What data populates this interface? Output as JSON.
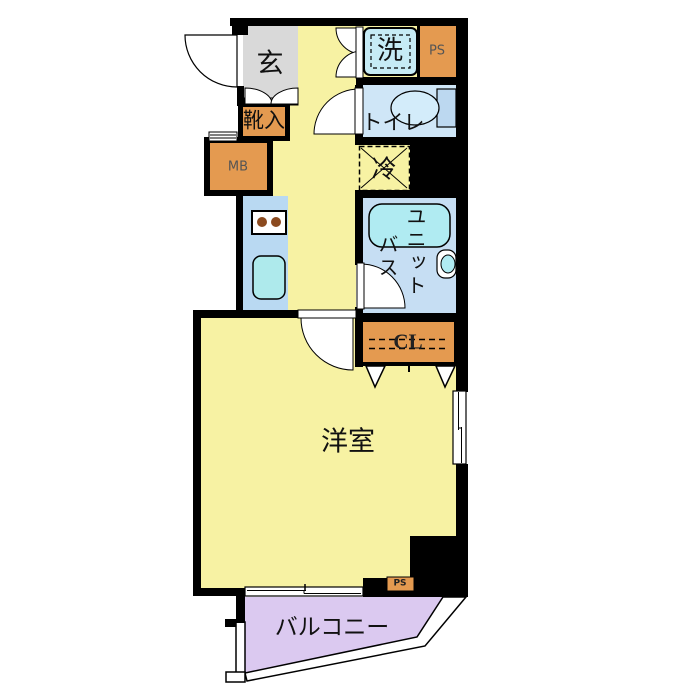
{
  "plan": {
    "title": "apartment-floor-plan",
    "labels": {
      "genkan": "玄",
      "shoe_storage": "靴入",
      "meter_box": "MB",
      "pipe_space": "PS",
      "washer": "洗",
      "toilet": "トイレ",
      "refrigerator": "冷",
      "unit_bath_col1": "ユニット",
      "unit_bath_col2": "バス",
      "closet": "CL",
      "western_room": "洋室",
      "balcony": "バルコニー",
      "pipe_space_small": "PS"
    },
    "colors": {
      "floor_yellow": "#f7f2a3",
      "entry_gray": "#d9d9d9",
      "storage_orange": "#e49a50",
      "counter_blue": "#b9d9f2",
      "toilet_blue": "#cfe6f7",
      "bath_blue": "#c6def3",
      "fixture_cyan": "#aeeaec",
      "washer_blue": "#c6ebf5",
      "tub_cyan": "#b0ebf2",
      "tank_blue": "#bcd8f0",
      "bowl_blue": "#d3ecfa",
      "balcony_purple": "#dbc9f0",
      "burner_brown": "#8b4a1f",
      "wall_black": "#000000"
    }
  }
}
